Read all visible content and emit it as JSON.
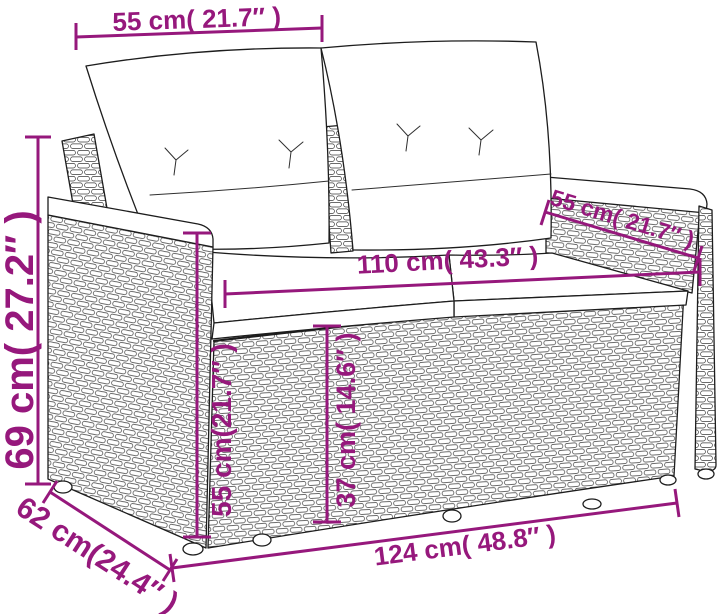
{
  "accent_color": "#96187c",
  "illustration": {
    "description": "Line drawing of a poly rattan 2-seater garden sofa with two back cushions and two seat cushions",
    "stroke_color": "#1d1d1d",
    "background_color": "#ffffff"
  },
  "dimensions": {
    "back_cushion_width": {
      "label": "55 cm( 21.7″ )",
      "value_cm": 55,
      "value_in": "21.7"
    },
    "overall_height": {
      "label": "69 cm( 27.2″ )",
      "value_cm": 69,
      "value_in": "27.2"
    },
    "armrest_length": {
      "label": "55 cm( 21.7″ )",
      "value_cm": 55,
      "value_in": "21.7"
    },
    "seat_width": {
      "label": "110 cm( 43.3″ )",
      "value_cm": 110,
      "value_in": "43.3"
    },
    "armrest_height": {
      "label": "55 cm(21.7″ )",
      "value_cm": 55,
      "value_in": "21.7"
    },
    "seat_height": {
      "label": "37 cm( 14.6″ )",
      "value_cm": 37,
      "value_in": "14.6"
    },
    "overall_width": {
      "label": "124 cm( 48.8″ )",
      "value_cm": 124,
      "value_in": "48.8"
    },
    "overall_depth": {
      "label": "62 cm(24.4″ )",
      "value_cm": 62,
      "value_in": "24.4"
    }
  }
}
